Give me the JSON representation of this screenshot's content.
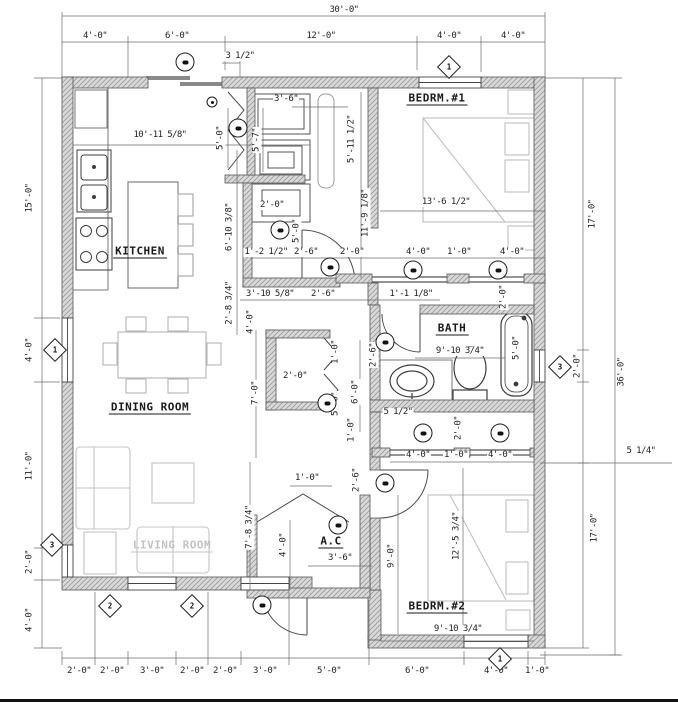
{
  "plan": {
    "colors": {
      "paper": "#ffffff",
      "line": "#3d3d3d",
      "dim_text": "#1e1e1e",
      "wall_fill": "#d9d9d9",
      "wall_hatch": "#999999",
      "muted_label": "#c3c3c3",
      "footer_bar": "#111111"
    },
    "rooms": [
      {
        "id": "kitchen",
        "label": "KITCHEN",
        "x": 140,
        "y": 252,
        "muted": 0
      },
      {
        "id": "dining-room",
        "label": "DINING ROOM",
        "x": 150,
        "y": 408,
        "muted": 0
      },
      {
        "id": "living-room",
        "label": "LIVING ROOM",
        "x": 172,
        "y": 546,
        "muted": 1
      },
      {
        "id": "bedroom-1",
        "label": "BEDRM.#1",
        "x": 437,
        "y": 99,
        "muted": 0
      },
      {
        "id": "bath",
        "label": "BATH",
        "x": 452,
        "y": 329,
        "muted": 0
      },
      {
        "id": "bedroom-2",
        "label": "BEDRM.#2",
        "x": 437,
        "y": 607,
        "muted": 0
      },
      {
        "id": "ac-closet",
        "label": "A.C",
        "x": 331,
        "y": 542,
        "muted": 0
      }
    ],
    "dimensions": [
      {
        "text": "30'-0\"",
        "x": 344,
        "y": 11,
        "r": 0
      },
      {
        "text": "4'-0\"",
        "x": 95,
        "y": 37,
        "r": 0
      },
      {
        "text": "6'-0\"",
        "x": 177,
        "y": 37,
        "r": 0
      },
      {
        "text": "12'-0\"",
        "x": 321,
        "y": 37,
        "r": 0
      },
      {
        "text": "4'-0\"",
        "x": 449,
        "y": 37,
        "r": 0
      },
      {
        "text": "4'-0\"",
        "x": 513,
        "y": 37,
        "r": 0
      },
      {
        "text": "3 1/2\"",
        "x": 240,
        "y": 57,
        "r": 0
      },
      {
        "text": "15'-0\"",
        "x": 30,
        "y": 198,
        "r": 1
      },
      {
        "text": "4'-0\"",
        "x": 30,
        "y": 350,
        "r": 1
      },
      {
        "text": "11'-0\"",
        "x": 30,
        "y": 466,
        "r": 1
      },
      {
        "text": "2'-0\"",
        "x": 30,
        "y": 562,
        "r": 1
      },
      {
        "text": "4'-0\"",
        "x": 30,
        "y": 620,
        "r": 1
      },
      {
        "text": "2'-0\"",
        "x": 79,
        "y": 672,
        "r": 0
      },
      {
        "text": "2'-0\"",
        "x": 112,
        "y": 672,
        "r": 0
      },
      {
        "text": "3'-0\"",
        "x": 152,
        "y": 672,
        "r": 0
      },
      {
        "text": "2'-0\"",
        "x": 192,
        "y": 672,
        "r": 0
      },
      {
        "text": "2'-0\"",
        "x": 225,
        "y": 672,
        "r": 0
      },
      {
        "text": "3'-0\"",
        "x": 265,
        "y": 672,
        "r": 0
      },
      {
        "text": "5'-0\"",
        "x": 329,
        "y": 672,
        "r": 0
      },
      {
        "text": "6'-0\"",
        "x": 417,
        "y": 672,
        "r": 0
      },
      {
        "text": "4'-0\"",
        "x": 496,
        "y": 672,
        "r": 0
      },
      {
        "text": "1'-0\"",
        "x": 537,
        "y": 672,
        "r": 0
      },
      {
        "text": "17'-0\"",
        "x": 593,
        "y": 214,
        "r": 1
      },
      {
        "text": "2'-0\"",
        "x": 578,
        "y": 366,
        "r": 1
      },
      {
        "text": "36'-0\"",
        "x": 622,
        "y": 372,
        "r": 1
      },
      {
        "text": "5 1/4\"",
        "x": 641,
        "y": 452,
        "r": 0
      },
      {
        "text": "17'-0\"",
        "x": 595,
        "y": 528,
        "r": 1
      },
      {
        "text": "10'-11 5/8\"",
        "x": 160,
        "y": 136,
        "r": 0
      },
      {
        "text": "5'-0\"",
        "x": 221,
        "y": 138,
        "r": 1
      },
      {
        "text": "5'-7\"",
        "x": 257,
        "y": 140,
        "r": 1
      },
      {
        "text": "3'-6\"",
        "x": 286,
        "y": 100,
        "r": 0
      },
      {
        "text": "5'-11 1/2\"",
        "x": 352,
        "y": 139,
        "r": 1
      },
      {
        "text": "6'-10 3/8\"",
        "x": 230,
        "y": 227,
        "r": 1
      },
      {
        "text": "2'-8 3/4\"",
        "x": 230,
        "y": 303,
        "r": 1
      },
      {
        "text": "4'-0\"",
        "x": 251,
        "y": 322,
        "r": 1
      },
      {
        "text": "2'-0\"",
        "x": 272,
        "y": 206,
        "r": 0
      },
      {
        "text": "5'-0\"",
        "x": 297,
        "y": 231,
        "r": 1
      },
      {
        "text": "11'-9 1/8\"",
        "x": 366,
        "y": 213,
        "r": 1
      },
      {
        "text": "13'-6 1/2\"",
        "x": 446,
        "y": 203,
        "r": 0
      },
      {
        "text": "1'-2 1/2\"",
        "x": 266,
        "y": 253,
        "r": 0
      },
      {
        "text": "2'-6\"",
        "x": 306,
        "y": 253,
        "r": 0
      },
      {
        "text": "2'-0\"",
        "x": 352,
        "y": 253,
        "r": 0
      },
      {
        "text": "4'-0\"",
        "x": 418,
        "y": 253,
        "r": 0
      },
      {
        "text": "1'-0\"",
        "x": 459,
        "y": 253,
        "r": 0
      },
      {
        "text": "4'-0\"",
        "x": 512,
        "y": 253,
        "r": 0
      },
      {
        "text": "3'-10 5/8\"",
        "x": 270,
        "y": 295,
        "r": 0
      },
      {
        "text": "2'-6\"",
        "x": 323,
        "y": 295,
        "r": 0
      },
      {
        "text": "1'-1 1/8\"",
        "x": 411,
        "y": 295,
        "r": 0
      },
      {
        "text": "2'-0\"",
        "x": 504,
        "y": 297,
        "r": 1
      },
      {
        "text": "7'-0\"",
        "x": 256,
        "y": 393,
        "r": 1
      },
      {
        "text": "2'-0\"",
        "x": 295,
        "y": 377,
        "r": 0
      },
      {
        "text": "1'-0\"",
        "x": 336,
        "y": 352,
        "r": 1
      },
      {
        "text": "5'-0\"",
        "x": 336,
        "y": 404,
        "r": 1
      },
      {
        "text": "6'-0\"",
        "x": 356,
        "y": 392,
        "r": 1
      },
      {
        "text": "2'-6\"",
        "x": 374,
        "y": 355,
        "r": 1
      },
      {
        "text": "1'-0\"",
        "x": 352,
        "y": 430,
        "r": 1
      },
      {
        "text": "9'-10 3/4\"",
        "x": 460,
        "y": 352,
        "r": 0
      },
      {
        "text": "5'-0\"",
        "x": 517,
        "y": 348,
        "r": 1
      },
      {
        "text": "5 1/2\"",
        "x": 398,
        "y": 413,
        "r": 0
      },
      {
        "text": "2'-0\"",
        "x": 459,
        "y": 428,
        "r": 1
      },
      {
        "text": "4'-0\"",
        "x": 418,
        "y": 456,
        "r": 0
      },
      {
        "text": "1'-0\"",
        "x": 456,
        "y": 456,
        "r": 0
      },
      {
        "text": "4'-0\"",
        "x": 500,
        "y": 456,
        "r": 0
      },
      {
        "text": "1'-0\"",
        "x": 307,
        "y": 479,
        "r": 0
      },
      {
        "text": "2'-6\"",
        "x": 357,
        "y": 480,
        "r": 1
      },
      {
        "text": "7'-8 3/4\"",
        "x": 250,
        "y": 527,
        "r": 1
      },
      {
        "text": "4'-0\"",
        "x": 284,
        "y": 545,
        "r": 1
      },
      {
        "text": "3'-6\"",
        "x": 340,
        "y": 559,
        "r": 0
      },
      {
        "text": "9'-0\"",
        "x": 392,
        "y": 556,
        "r": 1
      },
      {
        "text": "12'-5 3/4\"",
        "x": 457,
        "y": 536,
        "r": 1
      },
      {
        "text": "9'-10 3/4\"",
        "x": 458,
        "y": 630,
        "r": 0
      }
    ],
    "window_markers": [
      {
        "label": "1",
        "x": 449,
        "y": 67
      },
      {
        "label": "1",
        "x": 55,
        "y": 350
      },
      {
        "label": "3",
        "x": 52,
        "y": 545
      },
      {
        "label": "2",
        "x": 110,
        "y": 606
      },
      {
        "label": "2",
        "x": 192,
        "y": 606
      },
      {
        "label": "3",
        "x": 560,
        "y": 367
      },
      {
        "label": "1",
        "x": 500,
        "y": 659
      }
    ],
    "door_markers": [
      {
        "x": 185,
        "y": 62,
        "small": 0
      },
      {
        "x": 212,
        "y": 102,
        "small": 1
      },
      {
        "x": 238,
        "y": 128,
        "small": 0
      },
      {
        "x": 280,
        "y": 230,
        "small": 0
      },
      {
        "x": 330,
        "y": 267,
        "small": 0
      },
      {
        "x": 413,
        "y": 270,
        "small": 0
      },
      {
        "x": 498,
        "y": 270,
        "small": 0
      },
      {
        "x": 385,
        "y": 342,
        "small": 0
      },
      {
        "x": 327,
        "y": 403,
        "small": 0
      },
      {
        "x": 423,
        "y": 433,
        "small": 0
      },
      {
        "x": 500,
        "y": 433,
        "small": 0
      },
      {
        "x": 385,
        "y": 483,
        "small": 0
      },
      {
        "x": 338,
        "y": 525,
        "small": 0
      },
      {
        "x": 262,
        "y": 605,
        "small": 0
      }
    ]
  }
}
